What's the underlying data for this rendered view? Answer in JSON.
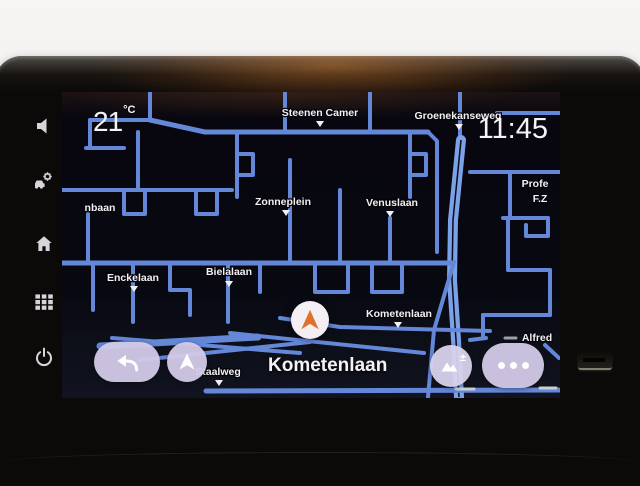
{
  "statusbar": {
    "temperature_value": "21",
    "temperature_unit": "°C",
    "time": "11:45"
  },
  "bottom_bar": {
    "current_street": "Kometenlaan"
  },
  "buttons": {
    "zoom_plusminus": "±"
  },
  "sidebar": {
    "keys": [
      "volume",
      "vehicle-settings",
      "home",
      "apps",
      "power"
    ]
  },
  "icons": [
    "speaker-icon",
    "car-gear-icon",
    "home-icon",
    "apps-grid-icon",
    "power-icon",
    "back-arrow-icon",
    "navigation-arrow-icon",
    "mountains-icon",
    "ellipsis-icon",
    "vehicle-arrow-icon"
  ],
  "map": {
    "colors": {
      "road": "#6487d8",
      "road_main": "#7ba1e8",
      "road_median": "#0a0c16",
      "label": "#f3eff3"
    },
    "roads": [
      {
        "w": 4,
        "pts": [
          [
            150,
            92
          ],
          [
            150,
            120
          ]
        ]
      },
      {
        "w": 4,
        "pts": [
          [
            90,
            120
          ],
          [
            150,
            120
          ]
        ]
      },
      {
        "w": 4,
        "pts": [
          [
            90,
            120
          ],
          [
            90,
            148
          ]
        ]
      },
      {
        "w": 4,
        "pts": [
          [
            86,
            148
          ],
          [
            124,
            148
          ]
        ]
      },
      {
        "w": 5,
        "pts": [
          [
            150,
            120
          ],
          [
            205,
            132
          ],
          [
            428,
            132
          ]
        ]
      },
      {
        "w": 4,
        "pts": [
          [
            428,
            132
          ],
          [
            437,
            141
          ],
          [
            437,
            252
          ]
        ]
      },
      {
        "w": 4,
        "pts": [
          [
            285,
            92
          ],
          [
            285,
            132
          ]
        ]
      },
      {
        "w": 4,
        "pts": [
          [
            370,
            92
          ],
          [
            370,
            132
          ]
        ]
      },
      {
        "w": 4,
        "pts": [
          [
            460,
            92
          ],
          [
            460,
            142
          ]
        ]
      },
      {
        "w": 4,
        "pts": [
          [
            497,
            113
          ],
          [
            559,
            113
          ]
        ]
      },
      {
        "w": 4,
        "pts": [
          [
            470,
            172
          ],
          [
            559,
            172
          ]
        ]
      },
      {
        "w": 4,
        "pts": [
          [
            510,
            172
          ],
          [
            510,
            218
          ]
        ]
      },
      {
        "w": 10,
        "main": true,
        "pts": [
          [
            461,
            140
          ],
          [
            453,
            220
          ],
          [
            452,
            280
          ],
          [
            456,
            340
          ],
          [
            459,
            397
          ]
        ]
      },
      {
        "w": 4,
        "pts": [
          [
            454,
            262
          ],
          [
            434,
            330
          ],
          [
            428,
            397
          ]
        ]
      },
      {
        "w": 4,
        "pts": [
          [
            237,
            132
          ],
          [
            237,
            197
          ]
        ]
      },
      {
        "w": 4,
        "pts": [
          [
            237,
            154
          ],
          [
            253,
            154
          ],
          [
            253,
            175
          ],
          [
            237,
            175
          ]
        ]
      },
      {
        "w": 4,
        "pts": [
          [
            410,
            132
          ],
          [
            410,
            197
          ]
        ]
      },
      {
        "w": 4,
        "pts": [
          [
            410,
            154
          ],
          [
            426,
            154
          ],
          [
            426,
            175
          ],
          [
            410,
            175
          ]
        ]
      },
      {
        "w": 4,
        "pts": [
          [
            290,
            160
          ],
          [
            290,
            263
          ]
        ]
      },
      {
        "w": 4,
        "pts": [
          [
            340,
            190
          ],
          [
            340,
            263
          ]
        ]
      },
      {
        "w": 4,
        "pts": [
          [
            390,
            218
          ],
          [
            390,
            263
          ]
        ]
      },
      {
        "w": 4,
        "pts": [
          [
            62,
            190
          ],
          [
            232,
            190
          ]
        ]
      },
      {
        "w": 4,
        "pts": [
          [
            138,
            132
          ],
          [
            138,
            190
          ]
        ]
      },
      {
        "w": 4,
        "pts": [
          [
            124,
            190
          ],
          [
            124,
            214
          ],
          [
            145,
            214
          ],
          [
            145,
            190
          ]
        ]
      },
      {
        "w": 4,
        "pts": [
          [
            196,
            190
          ],
          [
            196,
            214
          ],
          [
            217,
            214
          ],
          [
            217,
            190
          ]
        ]
      },
      {
        "w": 4,
        "pts": [
          [
            88,
            214
          ],
          [
            88,
            263
          ]
        ]
      },
      {
        "w": 5,
        "pts": [
          [
            62,
            263
          ],
          [
            452,
            263
          ]
        ]
      },
      {
        "w": 4,
        "pts": [
          [
            93,
            263
          ],
          [
            93,
            310
          ]
        ]
      },
      {
        "w": 4,
        "pts": [
          [
            133,
            263
          ],
          [
            133,
            322
          ]
        ]
      },
      {
        "w": 4,
        "pts": [
          [
            170,
            263
          ],
          [
            170,
            290
          ],
          [
            190,
            290
          ],
          [
            190,
            315
          ]
        ]
      },
      {
        "w": 4,
        "pts": [
          [
            228,
            263
          ],
          [
            228,
            322
          ]
        ]
      },
      {
        "w": 4,
        "pts": [
          [
            260,
            263
          ],
          [
            260,
            292
          ]
        ]
      },
      {
        "w": 4,
        "pts": [
          [
            315,
            263
          ],
          [
            315,
            292
          ],
          [
            348,
            292
          ],
          [
            348,
            263
          ]
        ]
      },
      {
        "w": 4,
        "pts": [
          [
            372,
            263
          ],
          [
            372,
            292
          ],
          [
            402,
            292
          ],
          [
            402,
            263
          ]
        ]
      },
      {
        "w": 4,
        "pts": [
          [
            280,
            318
          ],
          [
            340,
            327
          ],
          [
            490,
            331
          ]
        ]
      },
      {
        "w": 4,
        "pts": [
          [
            503,
            218
          ],
          [
            548,
            218
          ]
        ]
      },
      {
        "w": 4,
        "pts": [
          [
            548,
            218
          ],
          [
            548,
            236
          ],
          [
            526,
            236
          ],
          [
            526,
            225
          ]
        ]
      },
      {
        "w": 4,
        "pts": [
          [
            508,
            218
          ],
          [
            508,
            270
          ]
        ]
      },
      {
        "w": 4,
        "pts": [
          [
            508,
            270
          ],
          [
            550,
            270
          ]
        ]
      },
      {
        "w": 4,
        "pts": [
          [
            550,
            270
          ],
          [
            550,
            315
          ]
        ]
      },
      {
        "w": 4,
        "pts": [
          [
            483,
            315
          ],
          [
            550,
            315
          ]
        ]
      },
      {
        "w": 4,
        "pts": [
          [
            483,
            315
          ],
          [
            483,
            338
          ]
        ]
      },
      {
        "w": 4,
        "pts": [
          [
            470,
            340
          ],
          [
            486,
            338
          ]
        ]
      },
      {
        "w": 7,
        "pts": [
          [
            100,
            346
          ],
          [
            258,
            337
          ]
        ]
      },
      {
        "w": 4,
        "pts": [
          [
            112,
            338
          ],
          [
            300,
            353
          ]
        ]
      },
      {
        "w": 4,
        "pts": [
          [
            140,
            360
          ],
          [
            310,
            342
          ]
        ]
      },
      {
        "w": 4,
        "pts": [
          [
            230,
            333
          ],
          [
            424,
            353
          ]
        ]
      },
      {
        "w": 5,
        "pts": [
          [
            206,
            391
          ],
          [
            559,
            390
          ]
        ]
      },
      {
        "w": 4,
        "pts": [
          [
            545,
            345
          ],
          [
            559,
            358
          ]
        ]
      },
      {
        "w": 3,
        "c": "#c8cdd6",
        "pts": [
          [
            456,
            389
          ],
          [
            474,
            389
          ]
        ]
      },
      {
        "w": 3,
        "c": "#c8cdd6",
        "pts": [
          [
            540,
            388
          ],
          [
            556,
            388
          ]
        ]
      },
      {
        "w": 3,
        "c": "#9aa0ac",
        "pts": [
          [
            505,
            338
          ],
          [
            516,
            338
          ]
        ]
      }
    ],
    "labels": [
      {
        "text": "Steenen Camer",
        "x": 320,
        "y": 116,
        "marker": [
          320,
          121
        ]
      },
      {
        "text": "Groenekanseweg",
        "x": 458,
        "y": 119,
        "marker": [
          459,
          124
        ]
      },
      {
        "text": "Zonneplein",
        "x": 283,
        "y": 205,
        "marker": [
          286,
          210
        ]
      },
      {
        "text": "Venuslaan",
        "x": 392,
        "y": 206,
        "marker": [
          390,
          211
        ]
      },
      {
        "text": "Enckelaan",
        "x": 133,
        "y": 281,
        "marker": [
          134,
          286
        ]
      },
      {
        "text": "Bielalaan",
        "x": 229,
        "y": 275,
        "marker": [
          229,
          281
        ]
      },
      {
        "text": "Kometenlaan",
        "x": 399,
        "y": 317,
        "marker": [
          398,
          322
        ]
      },
      {
        "text": "Staalweg",
        "x": 218,
        "y": 375,
        "marker": [
          219,
          380
        ]
      },
      {
        "text": "Alfred",
        "x": 537,
        "y": 341
      },
      {
        "text": "nbaan",
        "x": 100,
        "y": 211
      },
      {
        "text": "Profe",
        "x": 535,
        "y": 187
      },
      {
        "text": "F.Z",
        "x": 540,
        "y": 202
      }
    ]
  }
}
